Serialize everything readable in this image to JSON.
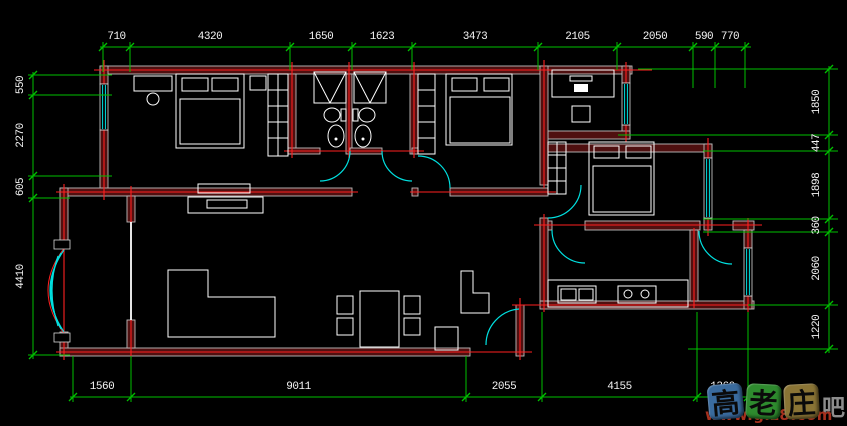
{
  "drawing": {
    "type": "apartment-floor-plan",
    "dimensions": {
      "top": [
        "710",
        "4320",
        "1650",
        "1623",
        "3473",
        "2105",
        "2050",
        "590",
        "770"
      ],
      "bottom": [
        "1560",
        "9011",
        "2055",
        "4155",
        "1360"
      ],
      "left": [
        "550",
        "2270",
        "605",
        "4410"
      ],
      "right": [
        "1850",
        "447",
        "1898",
        "360",
        "2060",
        "1220"
      ]
    }
  },
  "colors": {
    "background": "#000000",
    "dimension_lines": "#00c000",
    "dimension_text": "#f5f5f5",
    "wall_fill": "#4f1010",
    "wall_outline": "#bdbdbd",
    "axis_red": "#ff2020",
    "window_door_cyan": "#00e0e0",
    "furniture_white": "#ffffff"
  },
  "watermark": {
    "tiles": [
      {
        "char": "高",
        "color": "#3a6b9e"
      },
      {
        "char": "老",
        "color": "#2e8b2e"
      },
      {
        "char": "庄",
        "color": "#8a7435"
      }
    ],
    "suffix": "吧",
    "url": "www.glz8.com"
  }
}
